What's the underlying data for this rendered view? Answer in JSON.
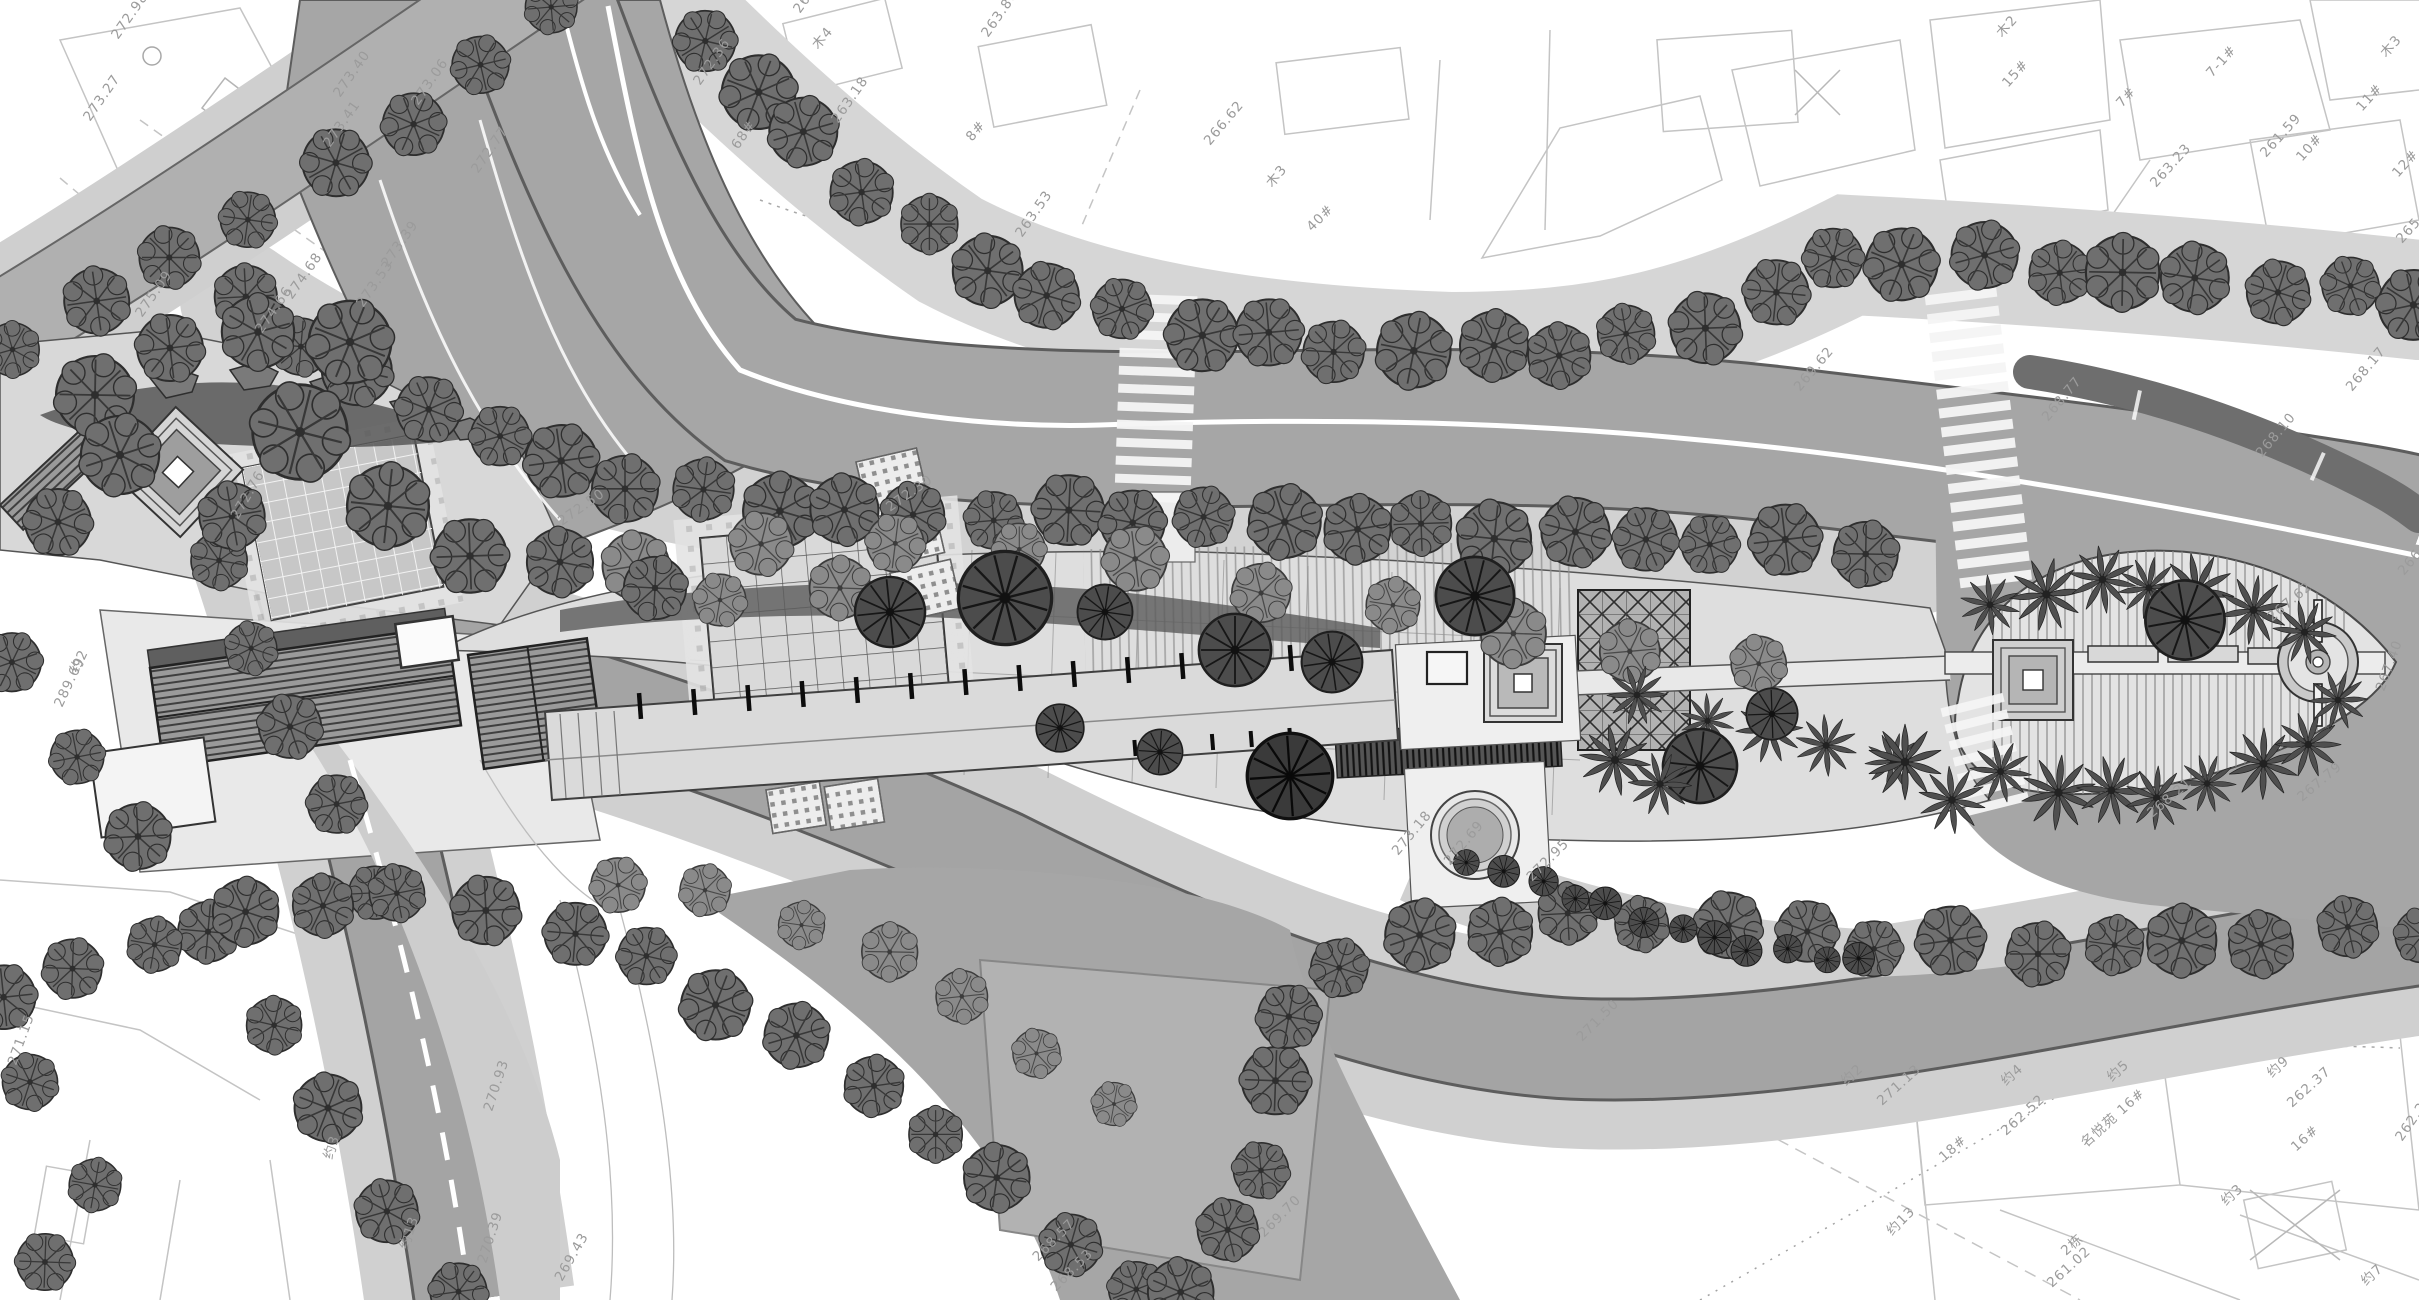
{
  "document": {
    "type": "landscape-masterplan-site-drawing",
    "style": "grayscale CAD plan render",
    "width": 2419,
    "height": 1300
  },
  "palette": {
    "paper": "#ffffff",
    "road": "#a6a6a6",
    "road_edge": "#5d5d5d",
    "sidewalk": "#d2d2d2",
    "park": "#dedede",
    "median_dark": "#6e6e6e",
    "tree_dark": "#6f6f6f",
    "tree_mid": "#8a8a8a",
    "shrub": "#4c4c4c",
    "cadastral_line": "#c4c4c4",
    "label_text": "#9b9b9b",
    "centerline": "#ffffff",
    "bench_tick": "#0c0c0c"
  },
  "annotations": {
    "spot_labels": [
      {
        "t": "272.98",
        "x": 118,
        "y": 40,
        "r": -55
      },
      {
        "t": "273.27",
        "x": 90,
        "y": 122,
        "r": -55
      },
      {
        "t": "275.09",
        "x": 142,
        "y": 318,
        "r": -55
      },
      {
        "t": "274.66",
        "x": 262,
        "y": 334,
        "r": -55
      },
      {
        "t": "274.68",
        "x": 292,
        "y": 300,
        "r": -55
      },
      {
        "t": "273.53",
        "x": 363,
        "y": 308,
        "r": -55
      },
      {
        "t": "273.39",
        "x": 388,
        "y": 268,
        "r": -55
      },
      {
        "t": "273.41",
        "x": 330,
        "y": 148,
        "r": -55
      },
      {
        "t": "273.40",
        "x": 340,
        "y": 98,
        "r": -55
      },
      {
        "t": "273.06",
        "x": 418,
        "y": 106,
        "r": -55
      },
      {
        "t": "272.77",
        "x": 478,
        "y": 174,
        "r": -55
      },
      {
        "t": "272.76",
        "x": 238,
        "y": 520,
        "r": -60
      },
      {
        "t": "272.36",
        "x": 700,
        "y": 86,
        "r": -55
      },
      {
        "t": "68#",
        "x": 738,
        "y": 150,
        "r": -55
      },
      {
        "t": "266.23",
        "x": 800,
        "y": 14,
        "r": -55
      },
      {
        "t": "263.80",
        "x": 988,
        "y": 38,
        "r": -55
      },
      {
        "t": "263.18",
        "x": 838,
        "y": 124,
        "r": -55
      },
      {
        "t": "263.53",
        "x": 1022,
        "y": 238,
        "r": -55
      },
      {
        "t": "木4",
        "x": 818,
        "y": 50,
        "r": -50
      },
      {
        "t": "8#",
        "x": 972,
        "y": 142,
        "r": -50
      },
      {
        "t": "266.62",
        "x": 1210,
        "y": 146,
        "r": -50
      },
      {
        "t": "木3",
        "x": 1272,
        "y": 188,
        "r": -50
      },
      {
        "t": "40#",
        "x": 1312,
        "y": 232,
        "r": -45
      },
      {
        "t": "7-1#",
        "x": 2212,
        "y": 78,
        "r": -48
      },
      {
        "t": "7#",
        "x": 2122,
        "y": 108,
        "r": -48
      },
      {
        "t": "15#",
        "x": 2008,
        "y": 88,
        "r": -48
      },
      {
        "t": "10#",
        "x": 2302,
        "y": 162,
        "r": -48
      },
      {
        "t": "11#",
        "x": 2362,
        "y": 112,
        "r": -48
      },
      {
        "t": "12#",
        "x": 2398,
        "y": 178,
        "r": -48
      },
      {
        "t": "木2",
        "x": 2002,
        "y": 38,
        "r": -48
      },
      {
        "t": "木3",
        "x": 2386,
        "y": 58,
        "r": -48
      },
      {
        "t": "261.59",
        "x": 2266,
        "y": 158,
        "r": -48
      },
      {
        "t": "263.23",
        "x": 2156,
        "y": 188,
        "r": -48
      },
      {
        "t": "265.90",
        "x": 2402,
        "y": 244,
        "r": -48
      },
      {
        "t": "269.62",
        "x": 1800,
        "y": 392,
        "r": -50
      },
      {
        "t": "268.77",
        "x": 2048,
        "y": 422,
        "r": -50
      },
      {
        "t": "268.10",
        "x": 2262,
        "y": 458,
        "r": -50
      },
      {
        "t": "268.17",
        "x": 2352,
        "y": 392,
        "r": -50
      },
      {
        "t": "267.62",
        "x": 2272,
        "y": 622,
        "r": -40
      },
      {
        "t": "267.40",
        "x": 2384,
        "y": 692,
        "r": -70
      },
      {
        "t": "267.79",
        "x": 2302,
        "y": 802,
        "r": -40
      },
      {
        "t": "268.21",
        "x": 2152,
        "y": 818,
        "r": -40
      },
      {
        "t": "266.95",
        "x": 2404,
        "y": 576,
        "r": -50
      },
      {
        "t": "272.50",
        "x": 562,
        "y": 526,
        "r": -35
      },
      {
        "t": "272.30",
        "x": 890,
        "y": 512,
        "r": -35
      },
      {
        "t": "273.18",
        "x": 1398,
        "y": 856,
        "r": -50
      },
      {
        "t": "272.69",
        "x": 1450,
        "y": 866,
        "r": -50
      },
      {
        "t": "272.95",
        "x": 1532,
        "y": 882,
        "r": -45
      },
      {
        "t": "271.50",
        "x": 1582,
        "y": 1042,
        "r": -45
      },
      {
        "t": "269.70",
        "x": 1264,
        "y": 1238,
        "r": -45
      },
      {
        "t": "268.57",
        "x": 1038,
        "y": 1262,
        "r": -45
      },
      {
        "t": "268.53",
        "x": 1056,
        "y": 1292,
        "r": -45
      },
      {
        "t": "270.93",
        "x": 492,
        "y": 1112,
        "r": -72
      },
      {
        "t": "270.39",
        "x": 486,
        "y": 1264,
        "r": -72
      },
      {
        "t": "269.43",
        "x": 562,
        "y": 1282,
        "r": -60
      },
      {
        "t": "约13",
        "x": 408,
        "y": 1250,
        "r": -72
      },
      {
        "t": "约3",
        "x": 332,
        "y": 1160,
        "r": -72
      },
      {
        "t": "289.69",
        "x": 62,
        "y": 708,
        "r": -65
      },
      {
        "t": "约2",
        "x": 78,
        "y": 674,
        "r": -65
      },
      {
        "t": "271.15",
        "x": 16,
        "y": 1066,
        "r": -70
      },
      {
        "t": "271.13",
        "x": 1882,
        "y": 1106,
        "r": -42
      },
      {
        "t": "约2",
        "x": 1846,
        "y": 1086,
        "r": -42
      },
      {
        "t": "约13",
        "x": 1892,
        "y": 1236,
        "r": -45
      },
      {
        "t": "18#",
        "x": 1944,
        "y": 1162,
        "r": -42
      },
      {
        "t": "约4",
        "x": 2006,
        "y": 1086,
        "r": -42
      },
      {
        "t": "262.52",
        "x": 2006,
        "y": 1136,
        "r": -42
      },
      {
        "t": "约5",
        "x": 2112,
        "y": 1082,
        "r": -42
      },
      {
        "t": "名悦苑 16#",
        "x": 2086,
        "y": 1148,
        "r": -42
      },
      {
        "t": "约9",
        "x": 2272,
        "y": 1078,
        "r": -42
      },
      {
        "t": "262.37",
        "x": 2292,
        "y": 1108,
        "r": -42
      },
      {
        "t": "16#",
        "x": 2296,
        "y": 1152,
        "r": -42
      },
      {
        "t": "约3",
        "x": 2226,
        "y": 1206,
        "r": -42
      },
      {
        "t": "2栋",
        "x": 2066,
        "y": 1256,
        "r": -42
      },
      {
        "t": "261.02",
        "x": 2052,
        "y": 1288,
        "r": -42
      },
      {
        "t": "262.26",
        "x": 2402,
        "y": 1142,
        "r": -55
      },
      {
        "t": "约7",
        "x": 2366,
        "y": 1286,
        "r": -42
      }
    ]
  },
  "vegetation": {
    "tree_rows": [
      {
        "name": "north-upper-left",
        "variant": "dark",
        "r": 30,
        "n": 8,
        "j": 6,
        "pts": [
          [
            10,
            345
          ],
          [
            150,
            272
          ],
          [
            310,
            183
          ],
          [
            470,
            80
          ],
          [
            555,
            8
          ]
        ]
      },
      {
        "name": "north-main",
        "variant": "dark",
        "r": 33,
        "n": 26,
        "j": 7,
        "pts": [
          [
            700,
            40
          ],
          [
            800,
            130
          ],
          [
            900,
            215
          ],
          [
            1000,
            278
          ],
          [
            1150,
            322
          ],
          [
            1350,
            350
          ],
          [
            1550,
            350
          ],
          [
            1680,
            335
          ],
          [
            1850,
            255
          ],
          [
            2000,
            263
          ],
          [
            2150,
            276
          ],
          [
            2300,
            289
          ],
          [
            2419,
            299
          ]
        ]
      },
      {
        "name": "south-main",
        "variant": "dark",
        "r": 33,
        "n": 24,
        "j": 6,
        "pts": [
          [
            240,
            300
          ],
          [
            330,
            362
          ],
          [
            425,
            403
          ],
          [
            520,
            450
          ],
          [
            620,
            482
          ],
          [
            760,
            505
          ],
          [
            900,
            516
          ],
          [
            1100,
            516
          ],
          [
            1300,
            523
          ],
          [
            1500,
            533
          ],
          [
            1700,
            541
          ],
          [
            1860,
            548
          ]
        ]
      },
      {
        "name": "west-road-outer",
        "variant": "dark",
        "r": 30,
        "n": 8,
        "j": 6,
        "pts": [
          [
            6,
            668
          ],
          [
            100,
            776
          ],
          [
            205,
            930
          ],
          [
            312,
            1085
          ],
          [
            405,
            1225
          ],
          [
            455,
            1296
          ]
        ]
      },
      {
        "name": "west-road-inner",
        "variant": "dark",
        "r": 28,
        "n": 5,
        "j": 5,
        "pts": [
          [
            215,
            565
          ],
          [
            265,
            668
          ],
          [
            320,
            780
          ],
          [
            372,
            888
          ]
        ]
      },
      {
        "name": "south-garland-west",
        "variant": "dark",
        "r": 31,
        "n": 16,
        "j": 7,
        "pts": [
          [
            0,
            1000
          ],
          [
            170,
            935
          ],
          [
            360,
            890
          ],
          [
            545,
            920
          ],
          [
            700,
            985
          ],
          [
            830,
            1060
          ],
          [
            950,
            1140
          ],
          [
            1060,
            1230
          ],
          [
            1130,
            1295
          ]
        ]
      },
      {
        "name": "south-garland-east",
        "variant": "dark",
        "r": 31,
        "n": 20,
        "j": 7,
        "pts": [
          [
            1180,
            1290
          ],
          [
            1240,
            1230
          ],
          [
            1265,
            1150
          ],
          [
            1270,
            1060
          ],
          [
            1300,
            990
          ],
          [
            1390,
            945
          ],
          [
            1520,
            920
          ],
          [
            1680,
            920
          ],
          [
            1840,
            940
          ],
          [
            2000,
            950
          ],
          [
            2160,
            945
          ],
          [
            2320,
            935
          ],
          [
            2419,
            930
          ]
        ]
      },
      {
        "name": "garland-inner",
        "variant": "mid",
        "r": 25,
        "n": 7,
        "j": 6,
        "pts": [
          [
            620,
            880
          ],
          [
            760,
            905
          ],
          [
            900,
            960
          ],
          [
            1020,
            1030
          ],
          [
            1110,
            1110
          ]
        ]
      },
      {
        "name": "park-row",
        "variant": "mid",
        "r": 30,
        "n": 10,
        "j": 6,
        "pts": [
          [
            640,
            560
          ],
          [
            800,
            545
          ],
          [
            960,
            540
          ],
          [
            1120,
            560
          ],
          [
            1280,
            590
          ],
          [
            1440,
            620
          ],
          [
            1600,
            645
          ],
          [
            1760,
            668
          ]
        ]
      },
      {
        "name": "shrub-hedge",
        "variant": "shrub",
        "r": 15,
        "n": 12,
        "j": 4,
        "pts": [
          [
            1470,
            860
          ],
          [
            1560,
            890
          ],
          [
            1660,
            925
          ],
          [
            1760,
            950
          ],
          [
            1860,
            960
          ]
        ]
      },
      {
        "name": "leaf-palms-top",
        "variant": "palm",
        "r": 34,
        "n": 7,
        "j": 5,
        "pts": [
          [
            1995,
            605
          ],
          [
            2070,
            585
          ],
          [
            2150,
            583
          ],
          [
            2230,
            600
          ],
          [
            2300,
            630
          ]
        ]
      },
      {
        "name": "leaf-palms-bottom",
        "variant": "palm",
        "r": 34,
        "n": 7,
        "j": 5,
        "pts": [
          [
            2005,
            775
          ],
          [
            2085,
            795
          ],
          [
            2165,
            795
          ],
          [
            2245,
            775
          ],
          [
            2305,
            740
          ]
        ]
      },
      {
        "name": "park-palms",
        "variant": "palm",
        "r": 32,
        "n": 5,
        "j": 5,
        "pts": [
          [
            1640,
            700
          ],
          [
            1725,
            722
          ],
          [
            1810,
            742
          ],
          [
            1895,
            758
          ]
        ]
      }
    ],
    "tree_singles": [
      [
        95,
        395,
        40,
        "dark"
      ],
      [
        170,
        348,
        36,
        "dark"
      ],
      [
        258,
        332,
        42,
        "dark"
      ],
      [
        350,
        342,
        38,
        "dark"
      ],
      [
        300,
        432,
        46,
        "dark"
      ],
      [
        388,
        506,
        42,
        "dark"
      ],
      [
        470,
        556,
        40,
        "dark"
      ],
      [
        232,
        516,
        38,
        "dark"
      ],
      [
        120,
        455,
        36,
        "dark"
      ],
      [
        58,
        522,
        32,
        "dark"
      ],
      [
        560,
        562,
        34,
        "dark"
      ],
      [
        655,
        588,
        34,
        "dark"
      ],
      [
        720,
        600,
        30,
        "mid"
      ],
      [
        840,
        588,
        28,
        "mid"
      ],
      [
        890,
        612,
        34,
        "shrub"
      ],
      [
        1005,
        598,
        48,
        "shrub"
      ],
      [
        1105,
        612,
        30,
        "shrub"
      ],
      [
        1235,
        650,
        42,
        "shrub"
      ],
      [
        1332,
        662,
        28,
        "shrub"
      ],
      [
        1475,
        596,
        38,
        "shrub"
      ],
      [
        1700,
        766,
        38,
        "shrub"
      ],
      [
        1772,
        714,
        28,
        "shrub"
      ],
      [
        2185,
        620,
        46,
        "shrub"
      ],
      [
        1060,
        728,
        22,
        "shrub"
      ],
      [
        1160,
        752,
        22,
        "shrub"
      ],
      [
        1290,
        776,
        44,
        "black"
      ],
      [
        30,
        1082,
        30,
        "dark"
      ],
      [
        95,
        1185,
        30,
        "dark"
      ],
      [
        45,
        1262,
        26,
        "dark"
      ]
    ],
    "palm_singles": [
      [
        1905,
        762,
        0.95
      ],
      [
        1952,
        800,
        0.85
      ],
      [
        1615,
        760,
        0.9
      ],
      [
        1660,
        784,
        0.8
      ],
      [
        2338,
        700,
        0.75
      ]
    ]
  },
  "road_markings": {
    "crosswalks": [
      {
        "cx": 1156,
        "cy": 395,
        "w": 76,
        "len": 200,
        "rot": 2,
        "stripe": 9,
        "gap": 9
      },
      {
        "cx": 1978,
        "cy": 435,
        "w": 72,
        "len": 290,
        "rot": -7,
        "stripe": 10,
        "gap": 9
      },
      {
        "cx": 1985,
        "cy": 755,
        "w": 64,
        "len": 112,
        "rot": -14,
        "stripe": 9,
        "gap": 8
      }
    ],
    "median_gaps": [
      {
        "x": 2138,
        "y": 390,
        "r": 12
      },
      {
        "x": 2322,
        "y": 452,
        "r": 24
      }
    ],
    "bench_ticks": [
      {
        "x1": 640,
        "y1": 706,
        "x2": 1345,
        "y2": 654,
        "n": 14,
        "len": 26,
        "w": 4.5
      },
      {
        "x1": 1135,
        "y1": 748,
        "x2": 1290,
        "y2": 736,
        "n": 5,
        "len": 16,
        "w": 4
      }
    ]
  }
}
